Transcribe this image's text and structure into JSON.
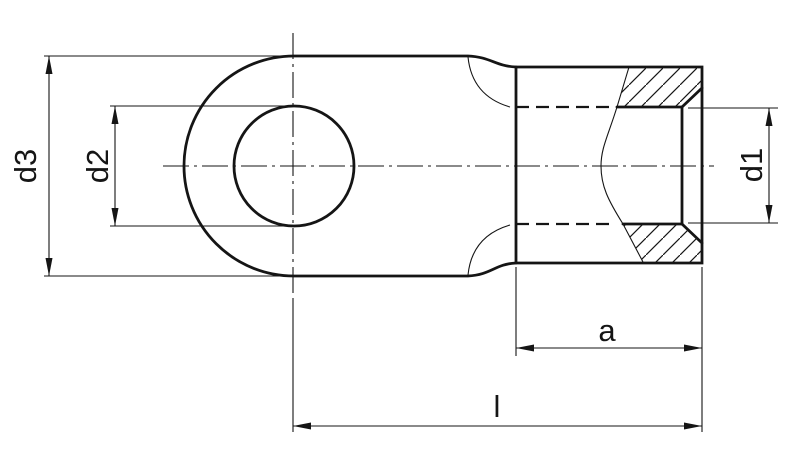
{
  "figure": {
    "kind": "engineering-drawing",
    "subject": "ring terminal side view with partial section",
    "background_color": "#ffffff",
    "line_color": "#151515"
  },
  "dimension_labels": {
    "outer_diameter": "d3",
    "hole_diameter": "d2",
    "inner_diameter": "d1",
    "barrel_length": "a",
    "overall_length": "l"
  }
}
